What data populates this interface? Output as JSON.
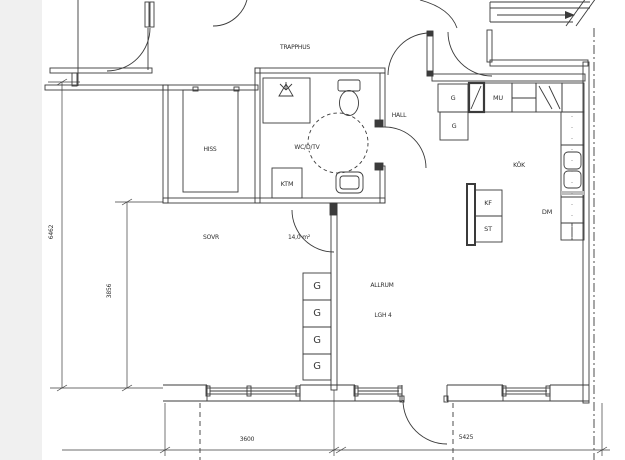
{
  "plan": {
    "rooms": {
      "trapphus": "TRAPPHUS",
      "hiss": "HISS",
      "wc": "WC/D/TV",
      "hall": "HALL",
      "kok": "KÖK",
      "sovr": "SOVR",
      "sovr_area": "14,0 m²",
      "allrum": "ALLRUM",
      "apartment": "LGH 4"
    },
    "fixtures": {
      "g": "G",
      "mu": "MU",
      "ktm": "KTM",
      "kf": "KF",
      "st": "ST",
      "dm": "DM"
    },
    "dimensions": {
      "total_height": "6462",
      "partial_height": "3856",
      "bottom_left_width": "3600",
      "bottom_right_width": "5425"
    },
    "colors": {
      "line": "#3b3b3b",
      "background": "#ffffff",
      "page_margin": "#f0f0f0"
    }
  }
}
